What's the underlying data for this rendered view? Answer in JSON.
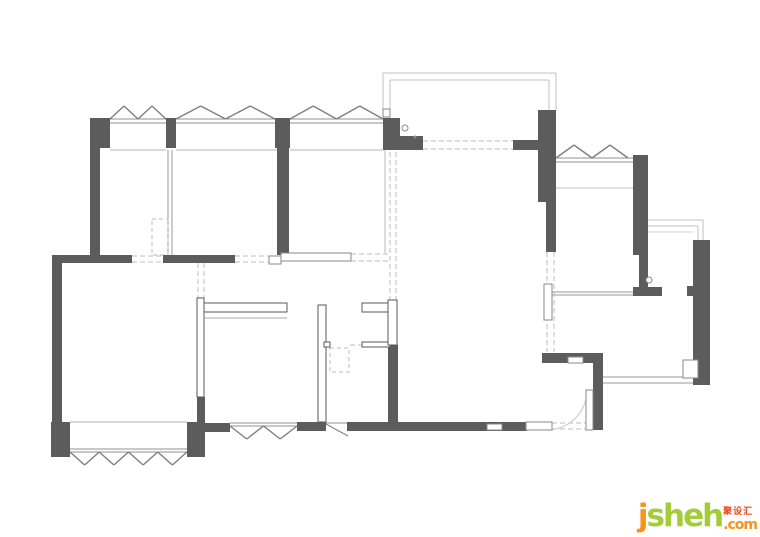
{
  "watermark": {
    "j": "j",
    "sheh": "sheheh",
    "sheh_fixed": "sheh",
    "cjk": "聚设汇",
    "tld": ".com",
    "color_orange": "#F7941D",
    "color_green": "#A4CC39",
    "color_red": "#E8491D"
  },
  "plan": {
    "colors": {
      "wall": "#5c5c5c",
      "outline_stroke": "#5a5a5a",
      "inset_stroke": "#8a8a8a",
      "line": "#b5b5b5",
      "sill": "#909090",
      "balcony": "#c2c2c2",
      "dash": "#bdbdbd",
      "casement": "#7f7f7f",
      "arc": "#cfcfcf",
      "symbol": "#8a8a8a"
    },
    "lines": [
      [
        110,
        119,
        166,
        119,
        "#909090"
      ],
      [
        110,
        123,
        166,
        123,
        "#909090"
      ],
      [
        176,
        119,
        275,
        119,
        "#909090"
      ],
      [
        176,
        123,
        275,
        123,
        "#909090"
      ],
      [
        290,
        119,
        383,
        119,
        "#909090"
      ],
      [
        290,
        123,
        383,
        123,
        "#909090"
      ],
      [
        556,
        158,
        633,
        158,
        "#909090"
      ],
      [
        556,
        162,
        633,
        162,
        "#909090"
      ],
      [
        70,
        449,
        187,
        449,
        "#909090"
      ],
      [
        70,
        452,
        187,
        452,
        "#909090"
      ],
      [
        230,
        423,
        297,
        423,
        "#909090"
      ],
      [
        230,
        426,
        297,
        426,
        "#909090"
      ],
      [
        326,
        423,
        348,
        423,
        "#909090"
      ],
      [
        326,
        424,
        348,
        436,
        "#7f7f7f"
      ],
      [
        110,
        150,
        166,
        150,
        "#b5b5b5"
      ],
      [
        176,
        150,
        277,
        150,
        "#b5b5b5"
      ],
      [
        290,
        150,
        383,
        150,
        "#b5b5b5"
      ],
      [
        70,
        422,
        187,
        422,
        "#b0b0b0"
      ],
      [
        556,
        188,
        633,
        188,
        "#c2c2c2"
      ],
      [
        205,
        318,
        287,
        318,
        "#aaaaaa"
      ],
      [
        551,
        292,
        633,
        292,
        "#9a9a9a"
      ],
      [
        551,
        295,
        633,
        295,
        "#9a9a9a"
      ],
      [
        602,
        377,
        710,
        377,
        "#9a9a9a"
      ],
      [
        602,
        383,
        710,
        383,
        "#9a9a9a"
      ],
      [
        385,
        150,
        385,
        253,
        "#bbbbbb"
      ],
      [
        168,
        150,
        168,
        255,
        "#9a9a9a"
      ],
      [
        172,
        150,
        172,
        255,
        "#9a9a9a"
      ],
      [
        383,
        73,
        556,
        73,
        "#c2c2c2"
      ],
      [
        383,
        73,
        383,
        118,
        "#c2c2c2"
      ],
      [
        556,
        73,
        556,
        110,
        "#c2c2c2"
      ],
      [
        390,
        80,
        549,
        80,
        "#c2c2c2"
      ],
      [
        390,
        80,
        390,
        118,
        "#c2c2c2"
      ],
      [
        549,
        80,
        549,
        110,
        "#c2c2c2"
      ],
      [
        648,
        220,
        703,
        220,
        "#c2c2c2"
      ],
      [
        703,
        220,
        703,
        240,
        "#c2c2c2"
      ],
      [
        648,
        226,
        698,
        226,
        "#c2c2c2"
      ],
      [
        698,
        226,
        698,
        240,
        "#c2c2c2"
      ],
      [
        648,
        232,
        693,
        232,
        "#d2d2d2"
      ]
    ],
    "dashed_lines": [
      [
        423,
        141,
        513,
        141
      ],
      [
        423,
        149,
        513,
        149
      ],
      [
        132,
        256,
        163,
        256
      ],
      [
        132,
        262,
        163,
        262
      ],
      [
        235,
        256,
        269,
        256
      ],
      [
        235,
        262,
        269,
        262
      ],
      [
        351,
        254,
        388,
        254
      ],
      [
        351,
        261,
        388,
        261
      ],
      [
        390,
        152,
        390,
        300
      ],
      [
        396,
        152,
        396,
        300
      ],
      [
        198,
        263,
        198,
        298
      ],
      [
        204,
        263,
        204,
        298
      ],
      [
        547,
        252,
        547,
        352
      ],
      [
        554,
        252,
        554,
        352
      ],
      [
        552,
        423,
        587,
        423
      ],
      [
        552,
        429,
        587,
        429
      ],
      [
        350,
        345,
        362,
        345
      ]
    ],
    "dashed_rects": [
      [
        152,
        219,
        16,
        36
      ],
      [
        330,
        348,
        19,
        24
      ]
    ],
    "windows": [
      [
        110,
        166,
        119,
        -1,
        2
      ],
      [
        176,
        275,
        119,
        -1,
        2
      ],
      [
        290,
        383,
        119,
        -1,
        2
      ],
      [
        556,
        628,
        158,
        -1,
        2
      ],
      [
        70,
        187,
        452,
        1,
        4
      ],
      [
        230,
        297,
        426,
        1,
        2
      ]
    ],
    "walls": [
      [
        90,
        118,
        20,
        30
      ],
      [
        90,
        148,
        10,
        108
      ],
      [
        166,
        118,
        10,
        30
      ],
      [
        275,
        118,
        15,
        30
      ],
      [
        277,
        148,
        12,
        107
      ],
      [
        52,
        255,
        10,
        167
      ],
      [
        51,
        422,
        19,
        35
      ],
      [
        52,
        255,
        80,
        8
      ],
      [
        163,
        255,
        72,
        8
      ],
      [
        383,
        118,
        17,
        32
      ],
      [
        395,
        136,
        28,
        14
      ],
      [
        513,
        140,
        25,
        10
      ],
      [
        538,
        110,
        18,
        92
      ],
      [
        546,
        202,
        10,
        50
      ],
      [
        542,
        353,
        60,
        10
      ],
      [
        593,
        353,
        10,
        77
      ],
      [
        633,
        155,
        15,
        100
      ],
      [
        639,
        255,
        9,
        32
      ],
      [
        633,
        287,
        29,
        9
      ],
      [
        693,
        240,
        17,
        145
      ],
      [
        687,
        286,
        6,
        10
      ],
      [
        205,
        423,
        25,
        9
      ],
      [
        297,
        422,
        29,
        9
      ],
      [
        347,
        422,
        180,
        9
      ],
      [
        187,
        422,
        18,
        35
      ],
      [
        197,
        397,
        8,
        25
      ],
      [
        388,
        345,
        10,
        86
      ]
    ],
    "outline_walls": [
      [
        197,
        298,
        7,
        99
      ],
      [
        204,
        303,
        83,
        9
      ],
      [
        318,
        305,
        8,
        117
      ],
      [
        362,
        303,
        28,
        9
      ],
      [
        362,
        342,
        28,
        5
      ],
      [
        388,
        300,
        9,
        45
      ],
      [
        324,
        342,
        6,
        5
      ]
    ],
    "insets": [
      [
        269,
        256,
        12,
        8
      ],
      [
        281,
        253,
        70,
        8
      ],
      [
        544,
        284,
        8,
        36
      ],
      [
        568,
        357,
        15,
        6
      ],
      [
        487,
        424,
        15,
        6
      ],
      [
        526,
        422,
        26,
        8
      ],
      [
        383,
        109,
        7,
        8
      ],
      [
        586,
        390,
        7,
        40
      ],
      [
        683,
        360,
        15,
        18
      ]
    ],
    "arcs": [
      "M547,430 A40,40 0 0 0 587,390",
      "M685,362 A14,14 0 0 0 697,377"
    ],
    "circles": [
      [
        405,
        128,
        3
      ],
      [
        649,
        280,
        3
      ]
    ],
    "dots": [
      [
        415,
        137,
        1.5
      ]
    ]
  }
}
